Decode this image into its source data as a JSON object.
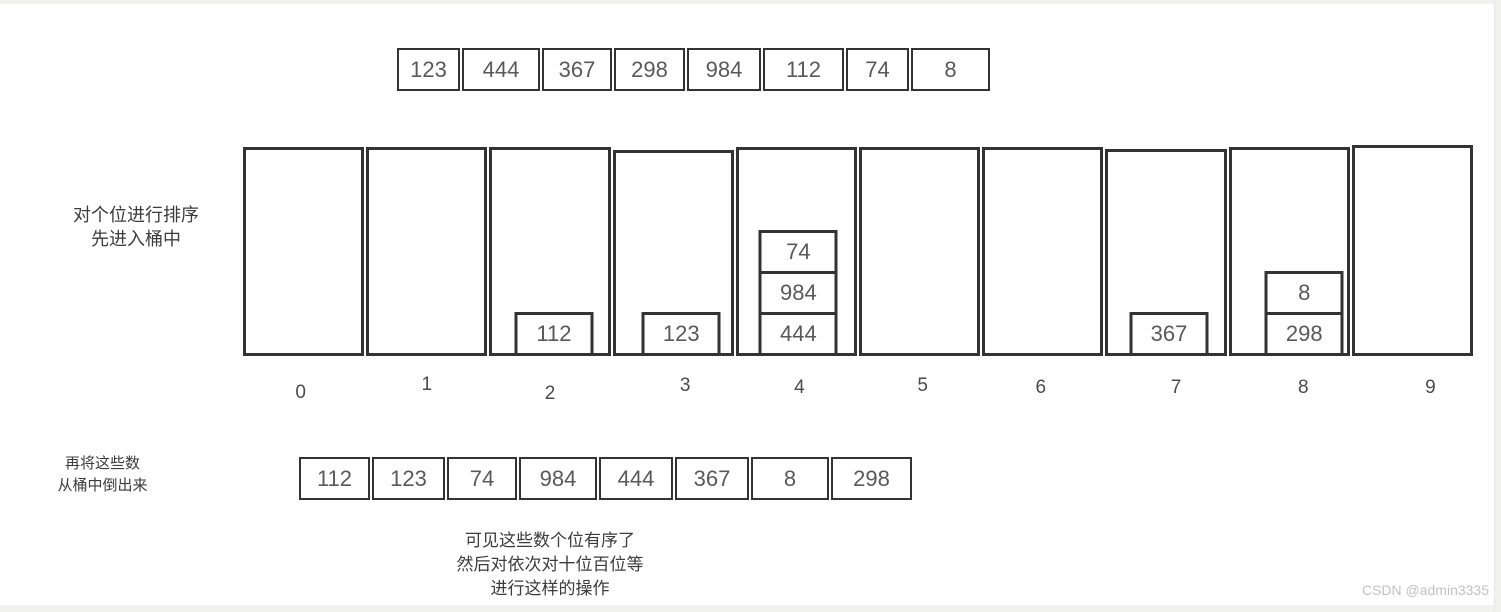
{
  "labels": {
    "step1_line1": "对个位进行排序",
    "step1_line2": "先进入桶中",
    "step2_line1": "再将这些数",
    "step2_line2": "从桶中倒出来",
    "caption_line1": "可见这些数个位有序了",
    "caption_line2": "然后对依次对十位百位等",
    "caption_line3": "进行这样的操作",
    "watermark": "CSDN @admin3335"
  },
  "top_array": [
    "123",
    "444",
    "367",
    "298",
    "984",
    "112",
    "74",
    "8"
  ],
  "bottom_array": [
    "112",
    "123",
    "74",
    "984",
    "444",
    "367",
    "8",
    "298"
  ],
  "buckets": [
    {
      "label": "0",
      "items": []
    },
    {
      "label": "1",
      "items": []
    },
    {
      "label": "2",
      "items": [
        "112"
      ]
    },
    {
      "label": "3",
      "items": [
        "123"
      ]
    },
    {
      "label": "4",
      "items": [
        "74",
        "984",
        "444"
      ]
    },
    {
      "label": "5",
      "items": []
    },
    {
      "label": "6",
      "items": []
    },
    {
      "label": "7",
      "items": [
        "367"
      ]
    },
    {
      "label": "8",
      "items": [
        "8",
        "298"
      ]
    },
    {
      "label": "9",
      "items": []
    }
  ],
  "colors": {
    "border": "#333333",
    "number_text": "#595959",
    "watermark": "#c2c2c2",
    "strip": "#f1f1ee"
  }
}
